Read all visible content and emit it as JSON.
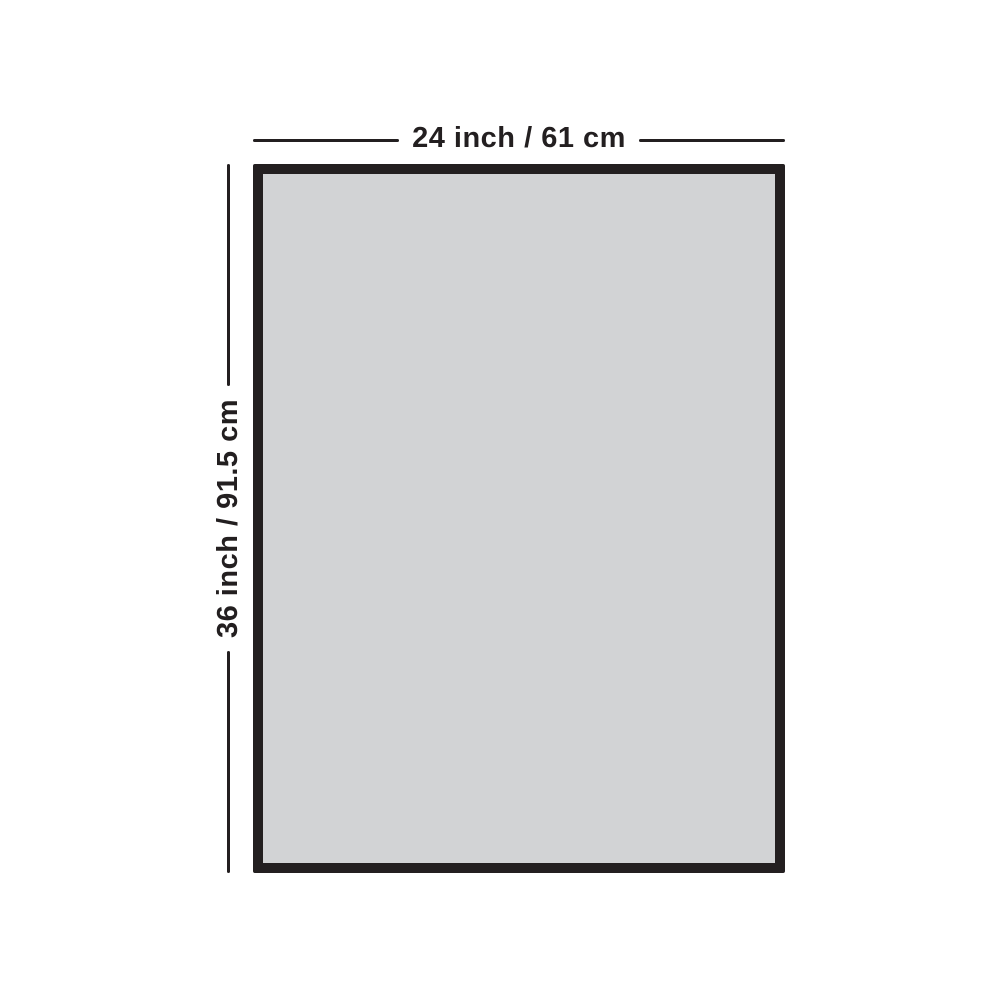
{
  "diagram": {
    "type": "product-dimension-diagram",
    "object": "rectangular board with dark frame border",
    "dimensions": {
      "width_label": "24 inch / 61 cm",
      "height_label": "36 inch / 91.5 cm",
      "width_inches": 24,
      "width_cm": 61,
      "height_inches": 36,
      "height_cm": 91.5
    },
    "colors": {
      "frame_border": "#231f20",
      "frame_fill": "#d2d3d5",
      "line": "#231f20",
      "text": "#231f20",
      "page_bg": "#ffffff"
    }
  }
}
